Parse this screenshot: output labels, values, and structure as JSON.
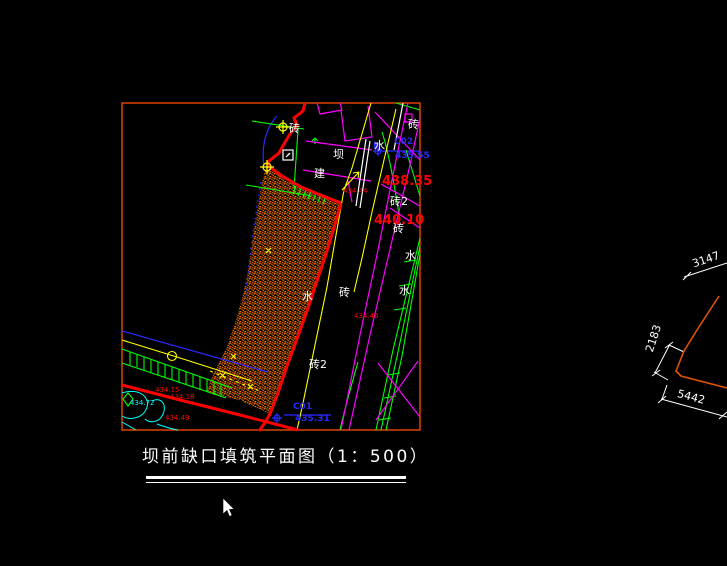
{
  "drawing": {
    "title": "坝前缺口填筑平面图（1：500）",
    "frame_color": "#ff4d00",
    "fill_hatch_color": "#ff7300",
    "boundary_color": "#ff0000",
    "labels": [
      {
        "name": "brick-label-1",
        "text": "砖",
        "x": 289,
        "y": 123,
        "color": "#ffffff",
        "size": 11
      },
      {
        "name": "dam-label",
        "text": "坝",
        "x": 333,
        "y": 149,
        "color": "#ffffff",
        "size": 11
      },
      {
        "name": "build-label",
        "text": "建",
        "x": 314,
        "y": 168,
        "color": "#ffffff",
        "size": 11
      },
      {
        "name": "water-label-1",
        "text": "水",
        "x": 374,
        "y": 140,
        "color": "#ffffff",
        "size": 11
      },
      {
        "name": "brick-label-2",
        "text": "砖",
        "x": 408,
        "y": 119,
        "color": "#ffffff",
        "size": 11
      },
      {
        "name": "brick2-label-1",
        "text": "砖2",
        "x": 390,
        "y": 196,
        "color": "#ffffff",
        "size": 11
      },
      {
        "name": "brick-label-3",
        "text": "砖",
        "x": 393,
        "y": 223,
        "color": "#ffffff",
        "size": 11
      },
      {
        "name": "water-label-2",
        "text": "水",
        "x": 405,
        "y": 250,
        "color": "#ffffff",
        "size": 11
      },
      {
        "name": "water-label-3",
        "text": "水",
        "x": 399,
        "y": 285,
        "color": "#ffffff",
        "size": 11
      },
      {
        "name": "water-label-4",
        "text": "水",
        "x": 302,
        "y": 291,
        "color": "#ffffff",
        "size": 11
      },
      {
        "name": "brick-label-4",
        "text": "砖",
        "x": 339,
        "y": 287,
        "color": "#ffffff",
        "size": 11
      },
      {
        "name": "brick2-label-2",
        "text": "砖2",
        "x": 309,
        "y": 359,
        "color": "#ffffff",
        "size": 11
      },
      {
        "name": "elevation-438-35",
        "text": "438.35",
        "x": 382,
        "y": 175,
        "color": "#ff0000",
        "size": 13,
        "bold": true
      },
      {
        "name": "elevation-440-10",
        "text": "440.10",
        "x": 374,
        "y": 214,
        "color": "#ff0000",
        "size": 13,
        "bold": true
      },
      {
        "name": "elevation-434-44",
        "text": "434.44",
        "x": 343,
        "y": 188,
        "color": "#ff0000",
        "size": 7
      },
      {
        "name": "elevation-434-46",
        "text": "434.46",
        "x": 354,
        "y": 313,
        "color": "#ff0000",
        "size": 7
      },
      {
        "name": "elevation-434-15",
        "text": "434.15",
        "x": 155,
        "y": 387,
        "color": "#ff0000",
        "size": 7
      },
      {
        "name": "elevation-434-18",
        "text": "434.18",
        "x": 170,
        "y": 394,
        "color": "#ff0000",
        "size": 7
      },
      {
        "name": "elevation-434-49",
        "text": "434.49",
        "x": 165,
        "y": 415,
        "color": "#ff0000",
        "size": 7
      },
      {
        "name": "elevation-434-72",
        "text": "434.72",
        "x": 130,
        "y": 400,
        "color": "#00ffff",
        "size": 7
      },
      {
        "name": "survey-point-c02",
        "text": "C02",
        "x": 394,
        "y": 138,
        "color": "#2a2aff",
        "size": 9,
        "bold": true
      },
      {
        "name": "elevation-435-55",
        "text": "435.55",
        "x": 395,
        "y": 152,
        "color": "#2a2aff",
        "size": 9,
        "bold": true
      },
      {
        "name": "survey-point-c01",
        "text": "C01",
        "x": 293,
        "y": 403,
        "color": "#2a2aff",
        "size": 9,
        "bold": true
      },
      {
        "name": "elevation-435-31",
        "text": "435.31",
        "x": 295,
        "y": 415,
        "color": "#2a2aff",
        "size": 9,
        "bold": true
      },
      {
        "name": "dim-3147",
        "text": "3147",
        "x": 691,
        "y": 259,
        "color": "#ffffff",
        "size": 11,
        "rotate": -19
      },
      {
        "name": "dim-2183",
        "text": "2183",
        "x": 644,
        "y": 350,
        "color": "#ffffff",
        "size": 11,
        "rotate": -72
      },
      {
        "name": "dim-5442",
        "text": "5442",
        "x": 679,
        "y": 388,
        "color": "#ffffff",
        "size": 11,
        "rotate": 15
      }
    ]
  }
}
